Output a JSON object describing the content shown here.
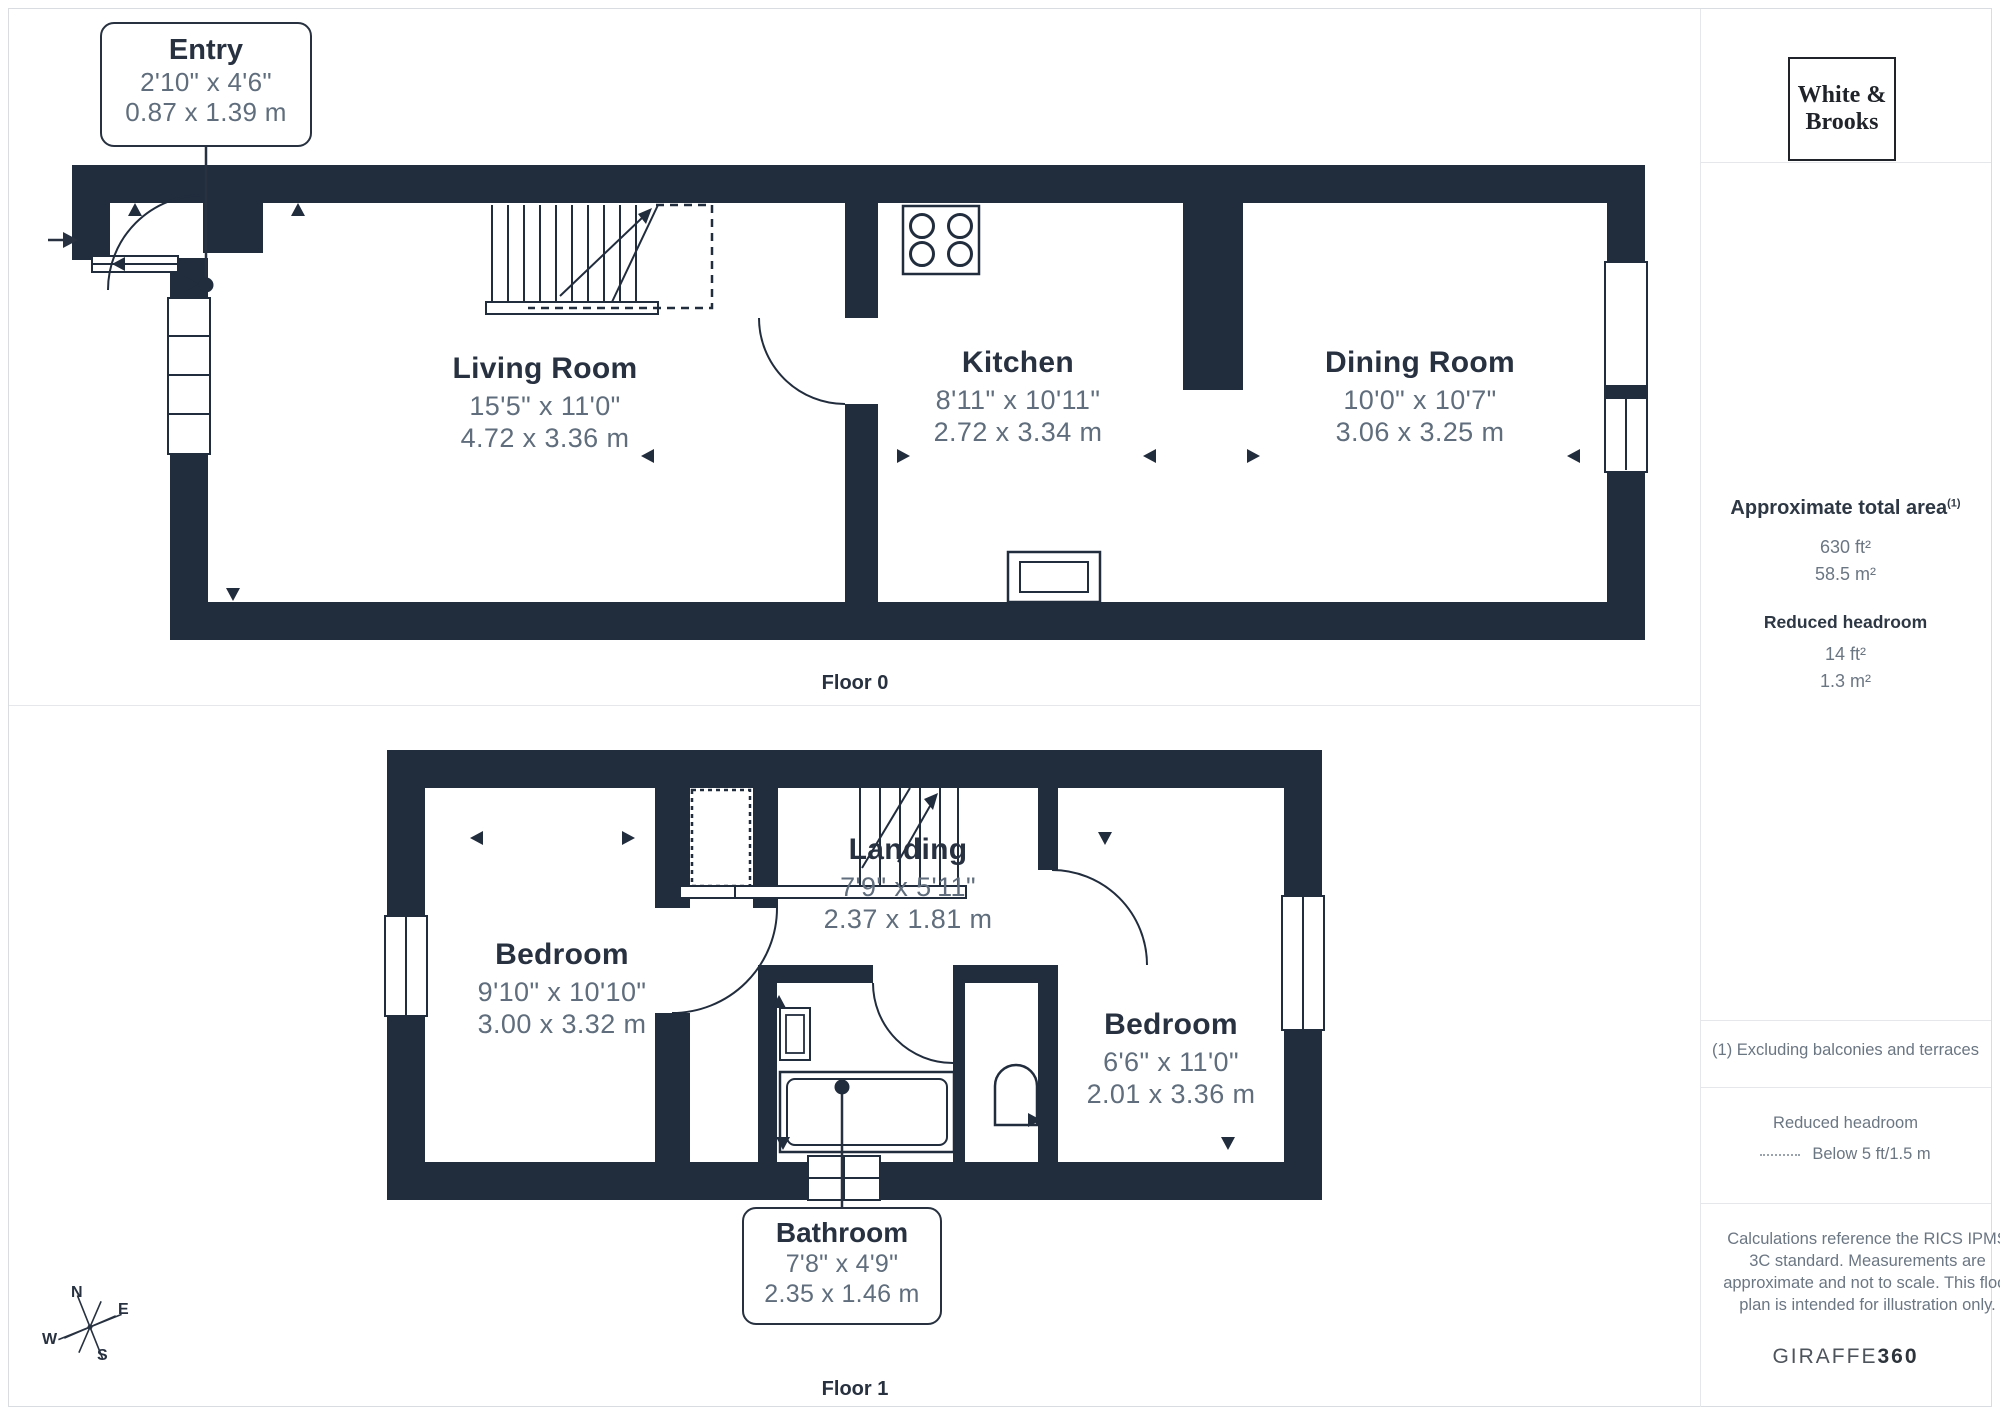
{
  "brand": {
    "logo_line1": "White &",
    "logo_line2": "Brooks"
  },
  "floor0": {
    "label": "Floor 0",
    "rooms": [
      {
        "name": "Living Room",
        "imperial": "15'5\" x 11'0\"",
        "metric": "4.72 x 3.36 m"
      },
      {
        "name": "Kitchen",
        "imperial": "8'11\" x 10'11\"",
        "metric": "2.72 x 3.34 m"
      },
      {
        "name": "Dining Room",
        "imperial": "10'0\" x 10'7\"",
        "metric": "3.06 x 3.25 m"
      }
    ],
    "callout": {
      "name": "Entry",
      "imperial": "2'10\" x 4'6\"",
      "metric": "0.87 x 1.39 m"
    }
  },
  "floor1": {
    "label": "Floor 1",
    "rooms": [
      {
        "name": "Bedroom",
        "imperial": "9'10\" x 10'10\"",
        "metric": "3.00 x 3.32 m"
      },
      {
        "name": "Landing",
        "imperial": "7'9\" x 5'11\"",
        "metric": "2.37 x 1.81 m"
      },
      {
        "name": "Bedroom",
        "imperial": "6'6\" x 11'0\"",
        "metric": "2.01 x 3.36 m"
      }
    ],
    "callout": {
      "name": "Bathroom",
      "imperial": "7'8\" x 4'9\"",
      "metric": "2.35 x 1.46 m"
    }
  },
  "sidebar": {
    "area_title": "Approximate total area",
    "area_sup": "(1)",
    "area_ft": "630 ft²",
    "area_m": "58.5 m²",
    "reduced_title": "Reduced headroom",
    "reduced_ft": "14 ft²",
    "reduced_m": "1.3 m²",
    "footnote": "(1) Excluding balconies and terraces",
    "legend_title": "Reduced headroom",
    "legend_text": "Below 5 ft/1.5 m",
    "disclaimer": "Calculations reference the RICS IPMS 3C standard. Measurements are approximate and not to scale. This floor plan is intended for illustration only.",
    "brand_footer_regular": "GIRAFFE",
    "brand_footer_bold": "360"
  },
  "compass": {
    "n": "N",
    "e": "E",
    "s": "S",
    "w": "W"
  },
  "icons": [
    "stairs-icon",
    "stove-icon",
    "sink-icon",
    "bathtub-icon",
    "toilet-icon",
    "door-arc-icon",
    "window-icon",
    "compass-icon",
    "entrance-arrow-icon"
  ],
  "colors": {
    "wall": "#212c3d",
    "room_name": "#273140",
    "dimension_text": "#5f6d7c",
    "divider": "#e5e7ea"
  }
}
